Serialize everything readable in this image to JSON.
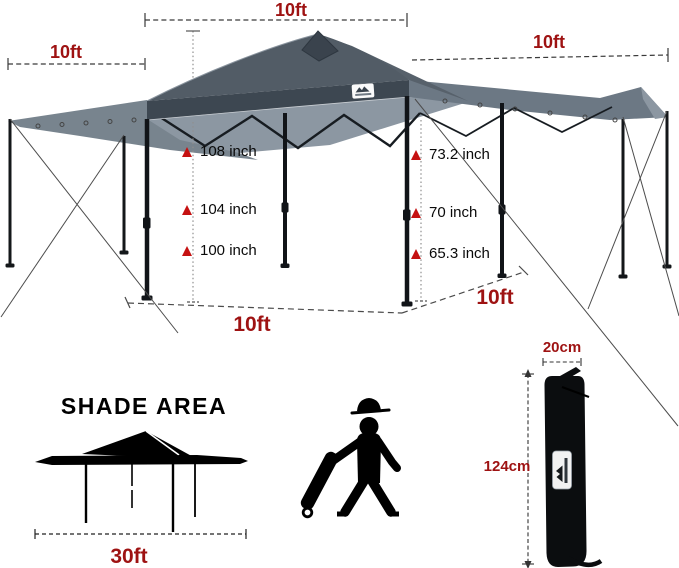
{
  "dimensions": {
    "top_width_label": "10ft",
    "left_awning_label": "10ft",
    "right_awning_label": "10ft",
    "base_width_label": "10ft",
    "base_depth_label": "10ft",
    "peak_heights": [
      "108 inch",
      "104 inch",
      "100 inch"
    ],
    "eave_heights": [
      "73.2 inch",
      "70 inch",
      "65.3 inch"
    ]
  },
  "shade_area": {
    "title": "SHADE AREA",
    "width_label": "30ft"
  },
  "carry_bag": {
    "width_label": "20cm",
    "height_label": "124cm"
  },
  "icons": {
    "canopy_logo": "mountain-logo-icon",
    "bag_logo": "mountain-logo-icon",
    "person": "worker-pulling-wheeled-bag-icon"
  },
  "colors": {
    "dimension_red": "#9e1212",
    "arrow_red": "#c51111",
    "canopy_roof": "#525c66",
    "canopy_valance": "#3d4751",
    "awning_gray": "#78848e",
    "underside_gray": "#8c97a2",
    "frame_black": "#111418"
  }
}
